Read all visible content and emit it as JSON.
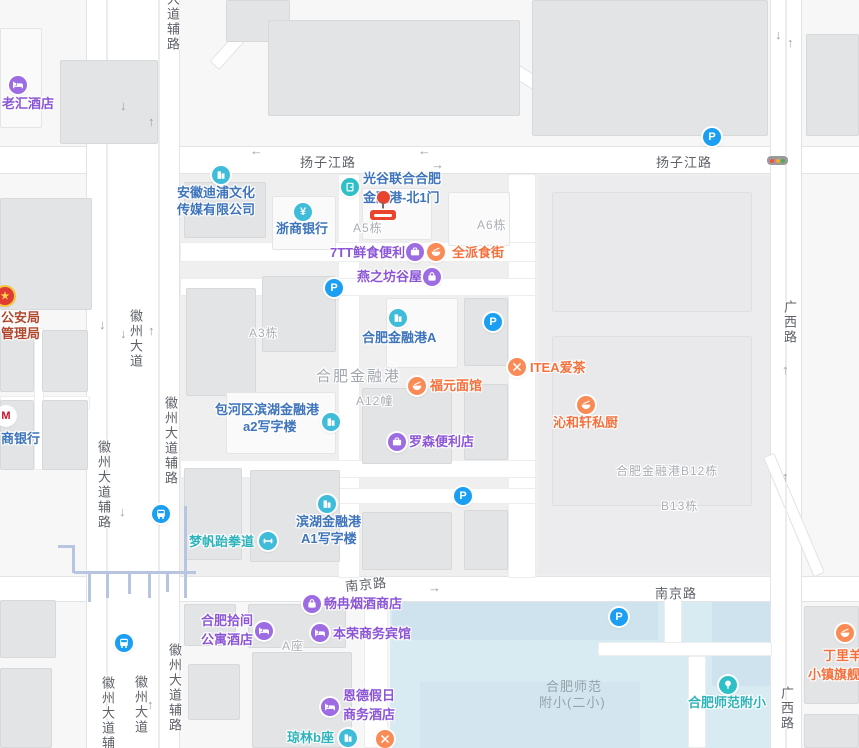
{
  "colors": {
    "poi_purple": "#8b55d6",
    "poi_blue": "#3e74bb",
    "poi_orange": "#f4703c",
    "poi_teal": "#2eb3ba",
    "poi_red": "#b0482f",
    "icon_purple": "#9d6ce2",
    "icon_cyan": "#3fbcd9",
    "icon_orange": "#fb8b56",
    "icon_teal": "#2fbfc6",
    "icon_blue": "#1b9ff2",
    "marker_red": "#e8442e",
    "school_area": "#d8eaf2",
    "road_label": "#5e6268",
    "building_label": "#a9aeb4"
  },
  "roads": {
    "yzj_w": "扬子江路",
    "yzj_e": "扬子江路",
    "njl_w": "南京路",
    "njl_e": "南京路",
    "gxl_n": "广西路",
    "gxl_s": "广西路",
    "hzdd_mid": "徽州大道",
    "hzdd_s": "徽州大道",
    "fl_top": "大道辅路",
    "fl_e1": "徽州大道辅路",
    "fl_w1": "徽州大道辅路",
    "fl_w2": "徽州大道辅路",
    "fl_e2": "徽州大道辅路"
  },
  "area_labels": {
    "a5": "A5栋",
    "a6": "A6栋",
    "a3": "A3栋",
    "a12": "A12幢",
    "azuo": "A座",
    "jrg": "合肥金融港",
    "b12": "合肥金融港B12栋",
    "b13": "B13栋",
    "school_l1": "合肥师范",
    "school_l2": "附小(二小)"
  },
  "pois": {
    "laohui": {
      "label": "老汇酒店"
    },
    "police": {
      "l1": "公安局",
      "l2": "管理局"
    },
    "cmb": {
      "label": "商银行"
    },
    "anhui_dipu": {
      "l1": "安徽迪浦文化",
      "l2": "传媒有限公司"
    },
    "zheshang": {
      "label": "浙商银行"
    },
    "guanggu": {
      "l1": "光谷联合合肥",
      "l2": "金融港-北1门"
    },
    "seven_tt": {
      "label": "7TT鲜食便利"
    },
    "quanpai": {
      "label": "全派食街"
    },
    "yanzhifang": {
      "label": "燕之坊谷屋"
    },
    "jrg_a": {
      "label": "合肥金融港A"
    },
    "fuyuan": {
      "label": "福元面馆"
    },
    "itea": {
      "label": "ITEA爱茶"
    },
    "qinhexuan": {
      "label": "沁和轩私厨"
    },
    "baohequ": {
      "l1": "包河区滨湖金融港",
      "l2": "a2写字楼"
    },
    "lawson": {
      "label": "罗森便利店"
    },
    "binhu_a1": {
      "l1": "滨湖金融港",
      "l2": "A1写字楼"
    },
    "mengfan": {
      "label": "梦帆跆拳道"
    },
    "changran": {
      "label": "畅冉烟酒商店"
    },
    "hefeishijian": {
      "l1": "合肥拾间",
      "l2": "公寓酒店"
    },
    "benrong": {
      "label": "本荣商务宾馆"
    },
    "ende": {
      "l1": "恩德假日",
      "l2": "商务酒店"
    },
    "qionglin": {
      "label": "琼林b座"
    },
    "shifan": {
      "label": "合肥师范附小"
    },
    "dingliyang": {
      "l1": "丁里羊",
      "l2": "小镇旗舰"
    }
  },
  "glyphs": {
    "parking": "P",
    "yuan": "¥",
    "m": "M",
    "star": "★",
    "arrow_left": "←",
    "arrow_right": "→",
    "arrow_up": "↑",
    "arrow_down": "↓"
  }
}
